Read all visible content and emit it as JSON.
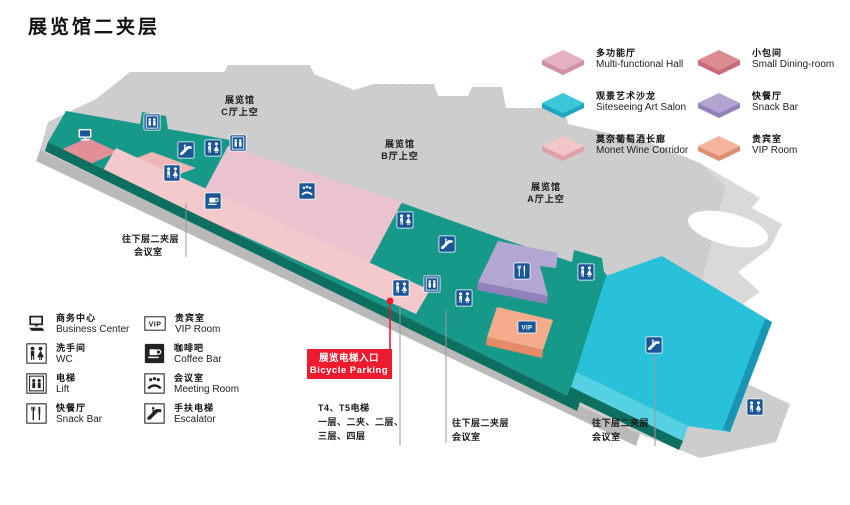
{
  "title": "展览馆二夹层",
  "colors": {
    "teal": "#17998a",
    "teal_edge": "#0c6f5f",
    "pink": "#eac3cf",
    "pink_edge": "#c9719a",
    "rose": "#e28f98",
    "salmon_block": "#eeb5b5",
    "corridor": "#f3c9cb",
    "purple": "#b4a6d2",
    "purple_edge": "#9181bd",
    "vip": "#f5ac8d",
    "vip_edge": "#e68a68",
    "cyan": "#29c1da",
    "cyan_light": "#55d1e3",
    "cyan_edge": "#1a96b4",
    "navy": "#1c5795",
    "red": "#ec1c2e"
  },
  "map": {
    "vip_text": "VIP",
    "halls": [
      {
        "l1": "展览馆",
        "l2": "C厅上空"
      },
      {
        "l1": "展览馆",
        "l2": "B厅上空"
      },
      {
        "l1": "展览馆",
        "l2": "A厅上空"
      }
    ],
    "annotations": {
      "left_meeting": {
        "l1": "往下层二夹层",
        "l2": "会议室"
      },
      "bicycle": {
        "l1": "展览电梯入口",
        "l2": "Bicycle Parking"
      },
      "t4": {
        "l1": "T4、T5电梯",
        "l2": "一层、二夹、二层、",
        "l3": "三层、四层"
      },
      "mid_meeting": {
        "l1": "往下层二夹层",
        "l2": "会议室"
      },
      "right_meeting": {
        "l1": "往下层二夹层",
        "l2": "会议室"
      }
    },
    "icons": [
      {
        "type": "computer",
        "x": 85,
        "y": 135
      },
      {
        "type": "lift",
        "x": 152,
        "y": 122
      },
      {
        "type": "escalator",
        "x": 186,
        "y": 150
      },
      {
        "type": "wc",
        "x": 213,
        "y": 148
      },
      {
        "type": "lift",
        "x": 238,
        "y": 143
      },
      {
        "type": "wc",
        "x": 172,
        "y": 173
      },
      {
        "type": "coffee",
        "x": 213,
        "y": 201
      },
      {
        "type": "meeting",
        "x": 307,
        "y": 191
      },
      {
        "type": "wc",
        "x": 405,
        "y": 220
      },
      {
        "type": "escalator",
        "x": 447,
        "y": 244
      },
      {
        "type": "wc",
        "x": 401,
        "y": 288
      },
      {
        "type": "lift",
        "x": 432,
        "y": 284
      },
      {
        "type": "wc",
        "x": 464,
        "y": 298
      },
      {
        "type": "fork",
        "x": 522,
        "y": 271
      },
      {
        "type": "wc",
        "x": 586,
        "y": 272
      },
      {
        "type": "vip",
        "x": 527,
        "y": 327
      },
      {
        "type": "escalator",
        "x": 654,
        "y": 345
      },
      {
        "type": "wc",
        "x": 755,
        "y": 407
      }
    ]
  },
  "legend_right": {
    "items": [
      {
        "cn": "多功能厅",
        "en": "Multi-functional Hall",
        "color_top": "#e5b1c2",
        "color_side": "#d08fa8"
      },
      {
        "cn": "观景艺术沙龙",
        "en": "Siteseeing Art Salon",
        "color_top": "#3ac8d9",
        "color_side": "#1fa6c1"
      },
      {
        "cn": "莫奈葡萄酒长廊",
        "en": "Monet Wine Corridor",
        "color_top": "#f2c5c9",
        "color_side": "#e0a0aa"
      },
      {
        "cn": "小包间",
        "en": "Small Dining-room",
        "color_top": "#dd8b93",
        "color_side": "#c66b75"
      },
      {
        "cn": "快餐厅",
        "en": "Snack Bar",
        "color_top": "#b2a3cf",
        "color_side": "#9480bc"
      },
      {
        "cn": "贵宾室",
        "en": "VIP Room",
        "color_top": "#f4b49e",
        "color_side": "#e08e72"
      }
    ]
  },
  "legend_left": {
    "items": [
      {
        "cn": "商务中心",
        "en": "Business Center",
        "icon": "computer"
      },
      {
        "cn": "洗手间",
        "en": "WC",
        "icon": "wc"
      },
      {
        "cn": "电梯",
        "en": "Lift",
        "icon": "lift"
      },
      {
        "cn": "快餐厅",
        "en": "Snack Bar",
        "icon": "fork"
      },
      {
        "cn": "贵宾室",
        "en": "VIP Room",
        "icon": "vip"
      },
      {
        "cn": "咖啡吧",
        "en": "Coffee Bar",
        "icon": "coffee"
      },
      {
        "cn": "会议室",
        "en": "Meeting Room",
        "icon": "meeting"
      },
      {
        "cn": "手扶电梯",
        "en": "Escalator",
        "icon": "escalator"
      }
    ]
  }
}
